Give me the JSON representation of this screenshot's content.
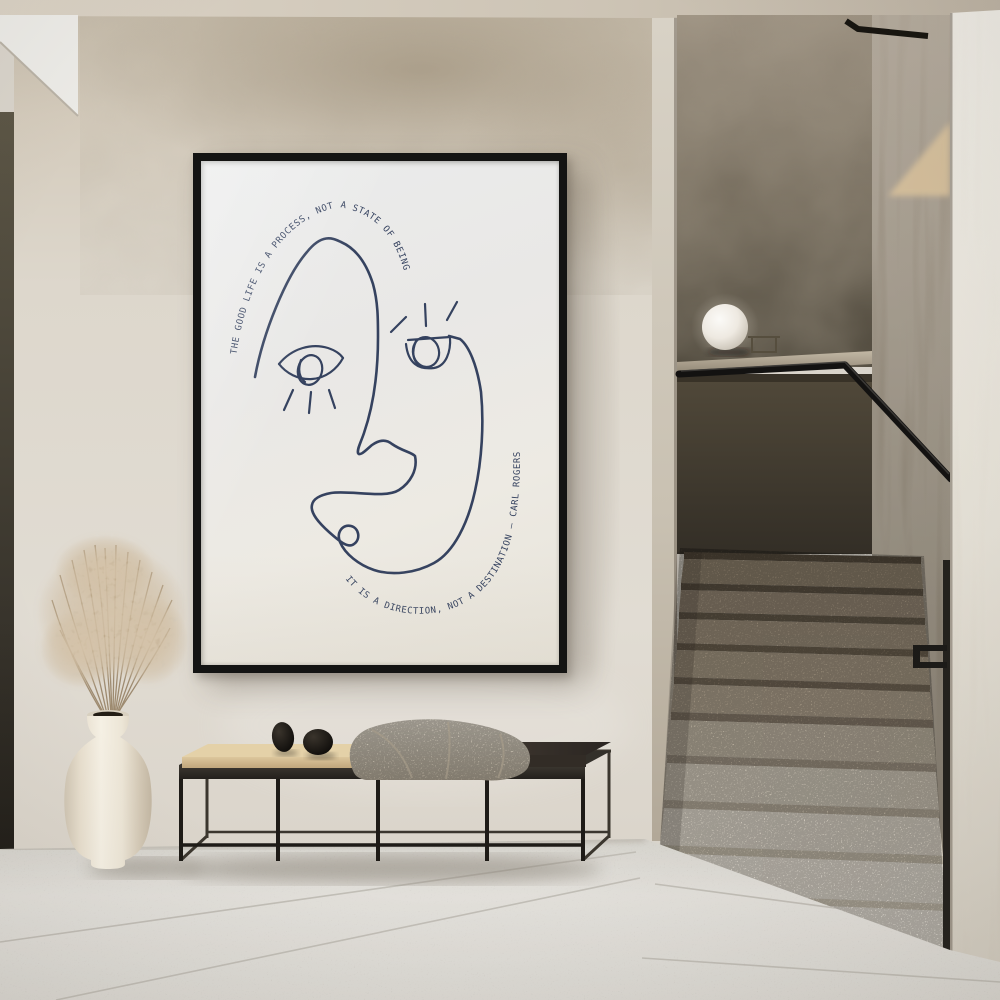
{
  "scene": {
    "description": "Minimal hallway interior: framed one-line face poster with Carl Rogers quote, black metal bench with cushion, pebble decor and blanket, white vase with dried pampas grass, globe lamp on concrete parapet, terrazzo staircase with black handrail"
  },
  "poster": {
    "quote_top": "THE GOOD LIFE IS A PROCESS, NOT A STATE OF BEING",
    "quote_bottom": "IT IS A DIRECTION, NOT A DESTINATION — CARL ROGERS",
    "author": "CARL ROGERS",
    "colors": {
      "ink": "#35425f",
      "paper": "#ebe9e4",
      "frame": "#141413"
    }
  },
  "palette": {
    "ceiling": "#d3cabd",
    "wall_main": "#ddd7cd",
    "wall_stain": "#9a8c77",
    "stairwell_back_wall": "#6e6557",
    "parapet": "#443d32",
    "ledge": "#b2a794",
    "lamp": "#f5f2ec",
    "handrail": "#141312",
    "stair_tread_upper": "#9b8e7a",
    "stair_tread_lower": "#e9e4da",
    "right_wall": "#e6e2d9",
    "floor": "#d7d4ce",
    "bench_frame": "#211e1a",
    "bench_cushion": "#d8c096",
    "bench_tray": "#332d27",
    "blanket": "#d5cdbf",
    "pebbles": "#16130f",
    "vase": "#efe9dc",
    "grass": "#b99f7d",
    "left_trim": "#4e4839"
  }
}
